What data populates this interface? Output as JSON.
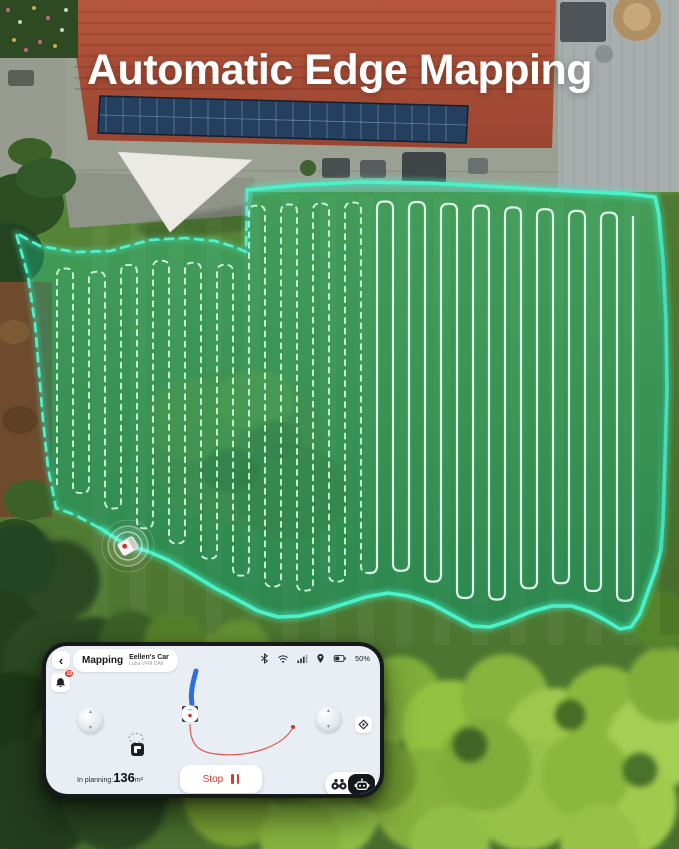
{
  "title": "Automatic Edge Mapping",
  "colors": {
    "boundary": "#3df0c6",
    "map_overlay": "#1db381",
    "accent_red": "#d93a2f",
    "path_blue": "#2f6fe0",
    "phone_screen": "#e8eef3"
  },
  "icons": {
    "back": "‹",
    "joystick_up": "▲",
    "joystick_down": "▼"
  },
  "phone": {
    "header": {
      "mode": "Mapping",
      "device_name": "Eellen's Car",
      "device_model": "Luba-VFM DA6",
      "notification_badge": "19",
      "battery_percent": "50%"
    },
    "map": {
      "planning_label": "In planning:",
      "planning_value": "136",
      "planning_unit": "m²"
    },
    "controls": {
      "stop_label": "Stop"
    }
  }
}
